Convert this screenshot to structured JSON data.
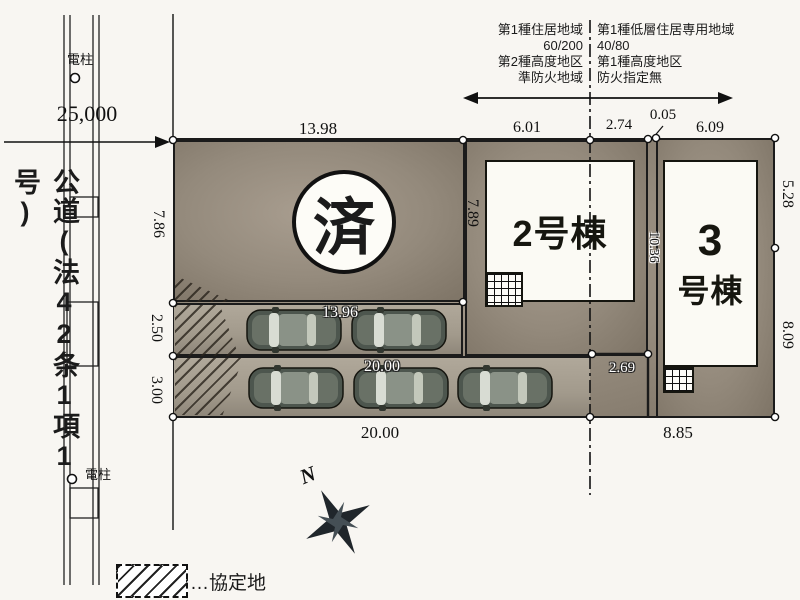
{
  "road": {
    "label": "公道(法42条1項1号)",
    "dim": "25,000",
    "pole_top": "電柱",
    "pole_bottom": "電柱"
  },
  "zoning": {
    "left": [
      "第1種住居地域",
      "60/200",
      "第2種高度地区",
      "準防火地域"
    ],
    "right": [
      "第1種低層住居専用地域",
      "40/80",
      "第1種高度地区",
      "防火指定無"
    ]
  },
  "sold_lot": {
    "stamp": "済"
  },
  "building2": {
    "label": "2号棟"
  },
  "building3": {
    "num": "3",
    "suffix": "号棟"
  },
  "dims": {
    "sold_top": "13.98",
    "sold_left": "7.86",
    "sold_right": "7.89",
    "b2_top_left": "6.01",
    "b2_top_right": "2.74",
    "gap": "0.05",
    "b3_top": "6.09",
    "b3_right_upper": "5.28",
    "b3_right_lower": "8.09",
    "b3_bottom": "8.85",
    "b2_bottom": "2.69",
    "between_lots": "10.36",
    "strip1_left": "2.50",
    "strip2_left": "3.00",
    "row1": "13.96",
    "row2": "20.00",
    "bottom": "20.00"
  },
  "legend": {
    "text": "…協定地"
  },
  "compass": {
    "label": "N"
  }
}
